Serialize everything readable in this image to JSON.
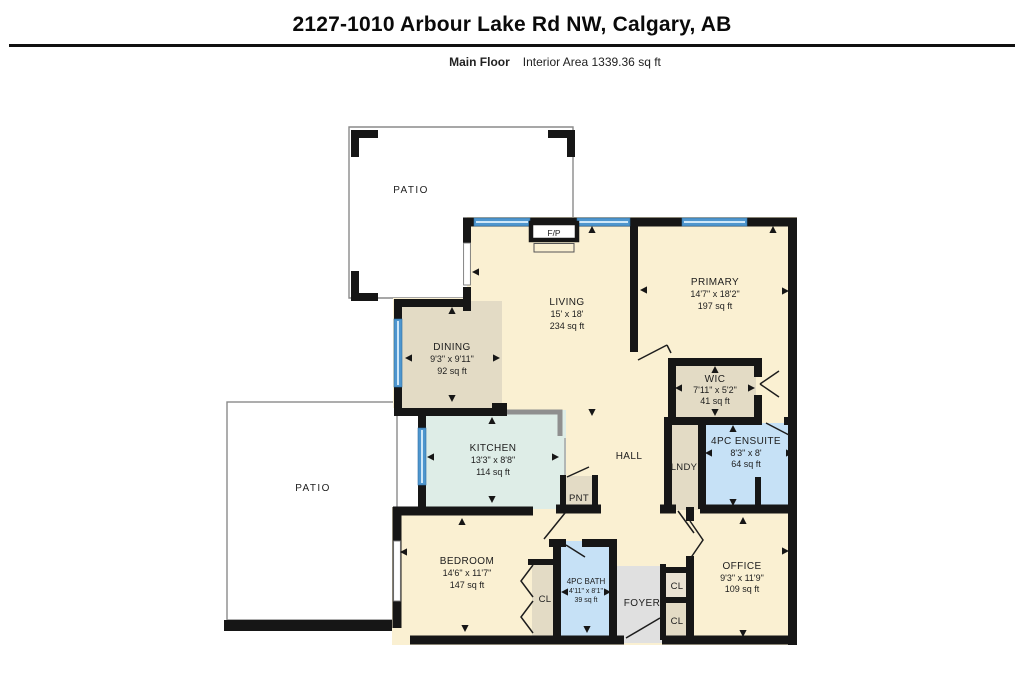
{
  "header": {
    "title": "2127-1010 Arbour Lake Rd NW, Calgary, AB",
    "floor_label": "Main Floor",
    "area_label": "Interior Area 1339.36 sq ft"
  },
  "rooms": {
    "patio_top": {
      "name": "PATIO"
    },
    "patio_left": {
      "name": "PATIO"
    },
    "fireplace": {
      "name": "F/P"
    },
    "living": {
      "name": "LIVING",
      "dims": "15' x 18'",
      "area": "234 sq ft"
    },
    "primary": {
      "name": "PRIMARY",
      "dims": "14'7\" x 18'2\"",
      "area": "197 sq ft"
    },
    "dining": {
      "name": "DINING",
      "dims": "9'3\" x 9'11\"",
      "area": "92 sq ft"
    },
    "kitchen": {
      "name": "KITCHEN",
      "dims": "13'3\" x 8'8\"",
      "area": "114 sq ft"
    },
    "hall": {
      "name": "HALL"
    },
    "pantry": {
      "name": "PNT"
    },
    "laundry": {
      "name": "LNDY"
    },
    "wic": {
      "name": "WIC",
      "dims": "7'11\" x 5'2\"",
      "area": "41 sq ft"
    },
    "ensuite": {
      "name": "4PC ENSUITE",
      "dims": "8'3\" x 8'",
      "area": "64 sq ft"
    },
    "bedroom": {
      "name": "BEDROOM",
      "dims": "14'6\" x 11'7\"",
      "area": "147 sq ft"
    },
    "bath": {
      "name": "4PC BATH",
      "dims": "4'11\" x 8'1\"",
      "area": "39 sq ft"
    },
    "closet_bedroom": {
      "name": "CL"
    },
    "foyer": {
      "name": "FOYER"
    },
    "closet_hall_upper": {
      "name": "CL"
    },
    "closet_hall_lower": {
      "name": "CL"
    },
    "office": {
      "name": "OFFICE",
      "dims": "9'3\" x 11'9\"",
      "area": "109 sq ft"
    }
  },
  "colors": {
    "wall": "#161616",
    "window_blue": "#4E96CE",
    "window_light": "#CFE7F8",
    "cream": "#FAF0D2",
    "tan": "#E3DBC5",
    "tan_light": "#EAE2D3",
    "mint": "#DEEDE7",
    "bath_blue": "#C6E1F6",
    "foyer_gray": "#E0E0E0",
    "patio_border": "#8A8A8A",
    "counter_gray": "#8F8F8F",
    "label_text": "#1D1D1D"
  },
  "plan": {
    "markers": [
      {
        "x": 592,
        "y": 230,
        "d": "u"
      },
      {
        "x": 773,
        "y": 230,
        "d": "u"
      },
      {
        "x": 452,
        "y": 311,
        "d": "u"
      },
      {
        "x": 492,
        "y": 421,
        "d": "u"
      },
      {
        "x": 715,
        "y": 370,
        "d": "u"
      },
      {
        "x": 733,
        "y": 429,
        "d": "u"
      },
      {
        "x": 462,
        "y": 522,
        "d": "u"
      },
      {
        "x": 743,
        "y": 521,
        "d": "u"
      },
      {
        "x": 476,
        "y": 272,
        "d": "l"
      },
      {
        "x": 644,
        "y": 290,
        "d": "l"
      },
      {
        "x": 409,
        "y": 358,
        "d": "l"
      },
      {
        "x": 431,
        "y": 457,
        "d": "l"
      },
      {
        "x": 679,
        "y": 388,
        "d": "l"
      },
      {
        "x": 709,
        "y": 453,
        "d": "l"
      },
      {
        "x": 404,
        "y": 552,
        "d": "l"
      },
      {
        "x": 565,
        "y": 592,
        "d": "l"
      },
      {
        "x": 785,
        "y": 291,
        "d": "r"
      },
      {
        "x": 496,
        "y": 358,
        "d": "r"
      },
      {
        "x": 555,
        "y": 457,
        "d": "r"
      },
      {
        "x": 751,
        "y": 388,
        "d": "r"
      },
      {
        "x": 789,
        "y": 453,
        "d": "r"
      },
      {
        "x": 785,
        "y": 551,
        "d": "r"
      },
      {
        "x": 607,
        "y": 592,
        "d": "r"
      },
      {
        "x": 452,
        "y": 398,
        "d": "d"
      },
      {
        "x": 492,
        "y": 499,
        "d": "d"
      },
      {
        "x": 592,
        "y": 412,
        "d": "d"
      },
      {
        "x": 715,
        "y": 412,
        "d": "d"
      },
      {
        "x": 733,
        "y": 502,
        "d": "d"
      },
      {
        "x": 465,
        "y": 628,
        "d": "d"
      },
      {
        "x": 587,
        "y": 629,
        "d": "d"
      },
      {
        "x": 743,
        "y": 633,
        "d": "d"
      }
    ]
  }
}
